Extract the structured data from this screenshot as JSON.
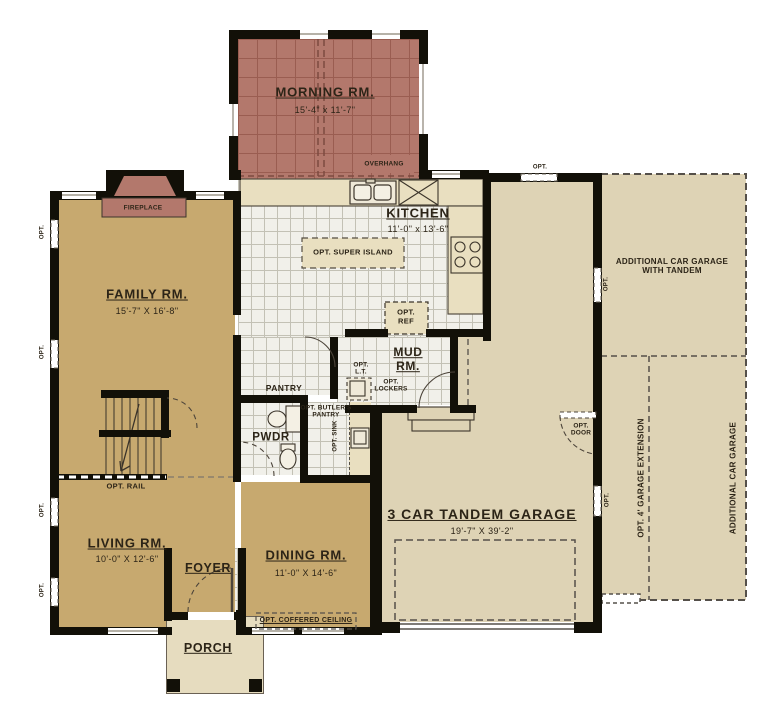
{
  "plan_title": "First floor plan",
  "colors": {
    "wall": "#121008",
    "room_tan": "#c7a96f",
    "garage_beige": "#ded3b5",
    "tile_light": "#f1f0ea",
    "morning_mauve": "#b3786c",
    "counter": "#e9dfc0",
    "text": "#2c2417"
  },
  "rooms": {
    "morning": {
      "name": "MORNING RM.",
      "dims": "15'-4\" x 11'-7\""
    },
    "kitchen": {
      "name": "KITCHEN",
      "dims": "11'-0\" x 13'-6\""
    },
    "family": {
      "name": "FAMILY RM.",
      "dims": "15'-7\" X 16'-8\""
    },
    "mud": {
      "name": "MUD RM."
    },
    "pantry": {
      "name": "PANTRY"
    },
    "butlers": {
      "name": "OPT. BUTLER'S PANTRY"
    },
    "pwdr": {
      "name": "PWDR"
    },
    "living": {
      "name": "LIVING RM.",
      "dims": "10'-0\" X 12'-6\""
    },
    "dining": {
      "name": "DINING RM.",
      "dims": "11'-0\" X 14'-6\""
    },
    "foyer": {
      "name": "FOYER"
    },
    "porch": {
      "name": "PORCH"
    },
    "garage": {
      "name": "3 CAR TANDEM GARAGE",
      "dims": "19'-7\" X 39'-2\""
    },
    "addl_garage_tandem": {
      "name": "ADDITIONAL CAR GARAGE WITH TANDEM"
    },
    "garage_extension": {
      "name": "OPT. 4' GARAGE EXTENSION"
    },
    "addl_car_garage": {
      "name": "ADDITIONAL CAR GARAGE"
    }
  },
  "annotations": {
    "fireplace": "FIREPLACE",
    "overhang": "OVERHANG",
    "opt_super_island": "OPT. SUPER ISLAND",
    "opt_ref": "OPT. REF",
    "opt_lt": "OPT. L.T.",
    "opt_lockers": "OPT. LOCKERS",
    "opt_sink": "OPT. SINK",
    "opt_rail": "OPT. RAIL",
    "opt_door": "OPT. DOOR",
    "opt_coffered_ceiling": "OPT. COFFERED CEILING",
    "opt": "OPT."
  }
}
